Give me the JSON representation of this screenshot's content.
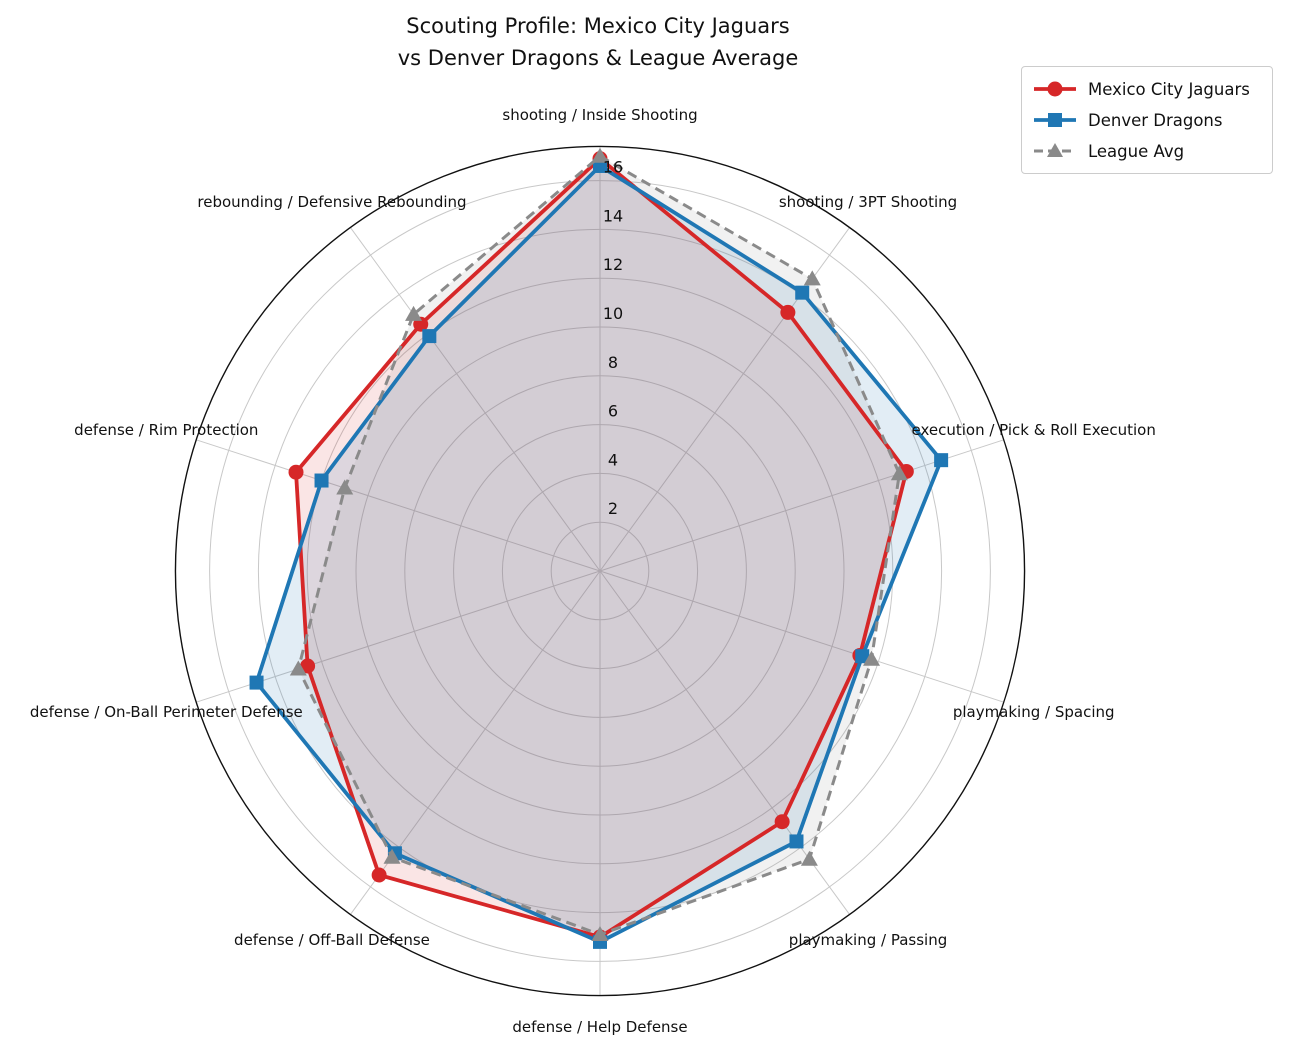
{
  "title": {
    "line1": "Scouting Profile: Mexico City Jaguars",
    "line2": "vs Denver Dragons & League Average"
  },
  "legend": {
    "items": [
      {
        "label": "Mexico City Jaguars",
        "color": "#d62728",
        "marker": "circle",
        "line": "solid"
      },
      {
        "label": "Denver Dragons",
        "color": "#1f77b4",
        "marker": "square",
        "line": "solid"
      },
      {
        "label": "League Avg",
        "color": "#8a8a8a",
        "marker": "triangle",
        "line": "dashed"
      }
    ]
  },
  "chart_data": {
    "type": "radar",
    "title": "Scouting Profile: Mexico City Jaguars vs Denver Dragons & League Average",
    "categories": [
      "shooting / Inside Shooting",
      "shooting / 3PT Shooting",
      "execution / Pick & Roll Execution",
      "playmaking / Spacing",
      "playmaking / Passing",
      "defense / Help Defense",
      "defense / Off-Ball Defense",
      "defense / On-Ball Perimeter Defense",
      "defense / Rim Protection",
      "rebounding / Defensive Rebounding"
    ],
    "series": [
      {
        "name": "Mexico City Jaguars",
        "color": "#d62728",
        "marker": "circle",
        "line": "solid",
        "values": [
          16.9,
          13.1,
          13.2,
          11.2,
          12.7,
          15.0,
          15.4,
          12.6,
          13.1,
          12.5
        ]
      },
      {
        "name": "Denver Dragons",
        "color": "#1f77b4",
        "marker": "square",
        "line": "solid",
        "values": [
          16.6,
          14.1,
          14.7,
          11.3,
          13.7,
          15.2,
          14.3,
          14.8,
          12.0,
          11.9
        ]
      },
      {
        "name": "League Avg",
        "color": "#8a8a8a",
        "marker": "triangle",
        "line": "dashed",
        "values": [
          17.0,
          14.8,
          12.9,
          11.7,
          14.6,
          14.9,
          14.5,
          13.0,
          11.0,
          13.0
        ]
      }
    ],
    "r_ticks": [
      2,
      4,
      6,
      8,
      10,
      12,
      14,
      16
    ],
    "r_max": 17.4,
    "grid": true,
    "direction": "clockwise",
    "start_angle": "top",
    "legend_position": "upper right"
  }
}
